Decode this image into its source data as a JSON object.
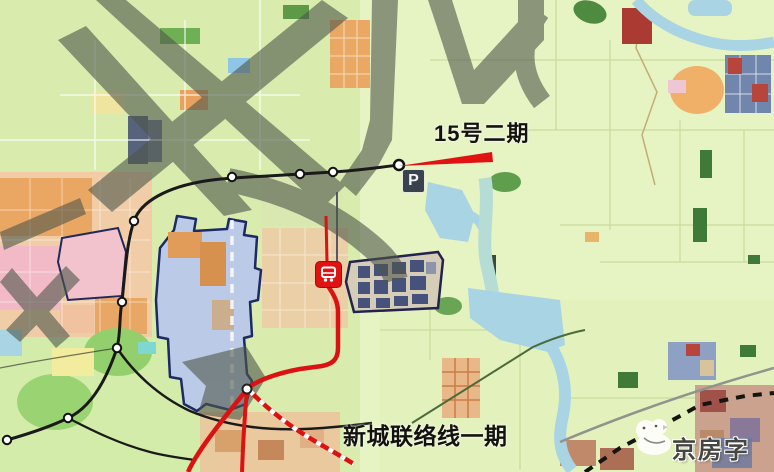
{
  "map": {
    "type": "transit-planning-map",
    "labels": {
      "line15_phase2": "15号二期",
      "new_town_connector_phase1": "新城联络线一期"
    },
    "badges": {
      "parking": "P"
    },
    "watermark": {
      "logo_text": "京房字"
    },
    "colors": {
      "metro_line": "#1a1a1a",
      "connector_line": "#dc1111",
      "annotation_red": "#e01212",
      "planned_district_fill": "#b9c7ec",
      "planned_district_outline": "#1c2a66",
      "water": "#a9d4e4",
      "farmland": "#e3f1bd",
      "watermark_gray": "#4e574b"
    }
  }
}
